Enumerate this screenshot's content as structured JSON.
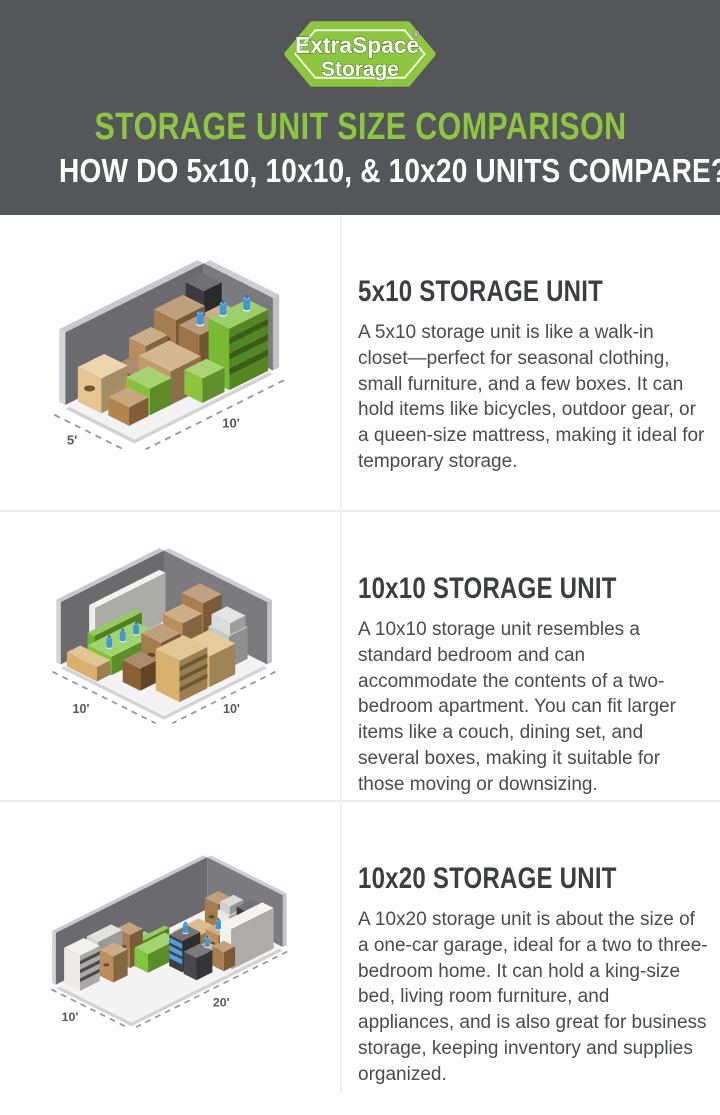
{
  "colors": {
    "brand_green": "#8dc63f",
    "header_bg": "#54565a",
    "heading_text": "#3d3e41",
    "body_text": "#4a4b4d"
  },
  "header": {
    "logo_line1": "ExtraSpace",
    "logo_reg": "®",
    "logo_line2": "Storage",
    "title": "STORAGE UNIT SIZE COMPARISON",
    "subtitle": "HOW DO 5x10, 10x10, & 10x20 UNITS COMPARE?"
  },
  "sections": [
    {
      "id": "5x10",
      "heading": "5x10 STORAGE UNIT",
      "body": "A 5x10 storage unit is like a walk-in closet—perfect for seasonal clothing, small furniture, and a few boxes. It can hold items like bicycles, outdoor gear, or a queen-size mattress, making it ideal for temporary storage.",
      "dim_left": "5'",
      "dim_right": "10'",
      "illustration_alt": "Isometric illustration of a 5x10 storage unit packed with boxes, a green shelf, and water jugs"
    },
    {
      "id": "10x10",
      "heading": "10x10 STORAGE UNIT",
      "body": "A 10x10 storage unit resembles a standard bedroom and can accommodate the contents of a two-bedroom apartment. You can fit larger items like a couch, dining set, and several boxes, making it suitable for those moving or downsizing.",
      "dim_left": "10'",
      "dim_right": "10'",
      "illustration_alt": "Isometric illustration of a 10x10 storage unit holding a couch, mattress, boxes, and furniture"
    },
    {
      "id": "10x20",
      "heading": "10x20 STORAGE UNIT",
      "body": "A 10x20 storage unit is about the size of a one-car garage, ideal for a two to three-bedroom home. It can hold a king-size bed, living room furniture, and appliances, and is also great for business storage, keeping inventory and supplies organized.",
      "dim_left": "10'",
      "dim_right": "20'",
      "illustration_alt": "Isometric illustration of a 10x20 storage unit filled with mattresses, appliances, furniture, and boxes"
    }
  ]
}
